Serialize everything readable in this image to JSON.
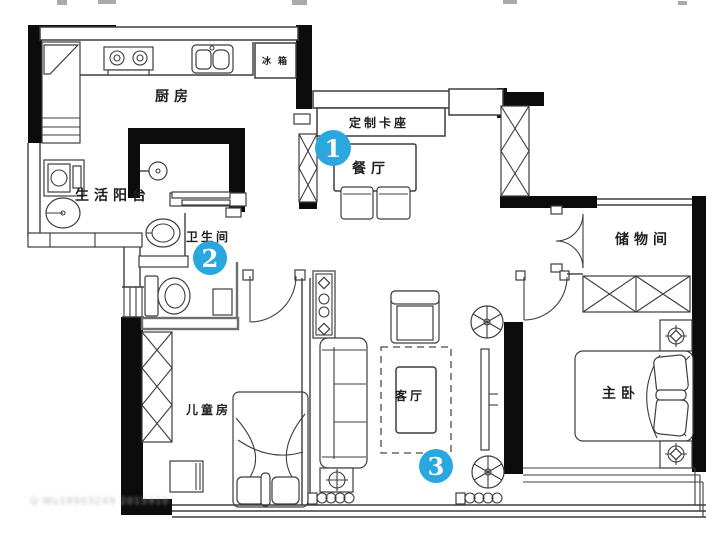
{
  "plan": {
    "rooms": {
      "kitchen": "厨房",
      "balcony": "生活阳台",
      "bathroom": "卫生间",
      "dining": "餐厅",
      "custom_booth": "定制卡座",
      "storage": "储物间",
      "kids_room": "儿童房",
      "living": "客厅",
      "master": "主卧",
      "fridge": "冰箱"
    },
    "markers": [
      {
        "number": "1"
      },
      {
        "number": "2"
      },
      {
        "number": "3"
      }
    ],
    "marker_color": "#2BA7E0",
    "wall_color": "#0c0c0c",
    "line_color": "#3d3d3d",
    "background": "#ffffff",
    "watermark": "Q·Wu18903249 2015910"
  }
}
